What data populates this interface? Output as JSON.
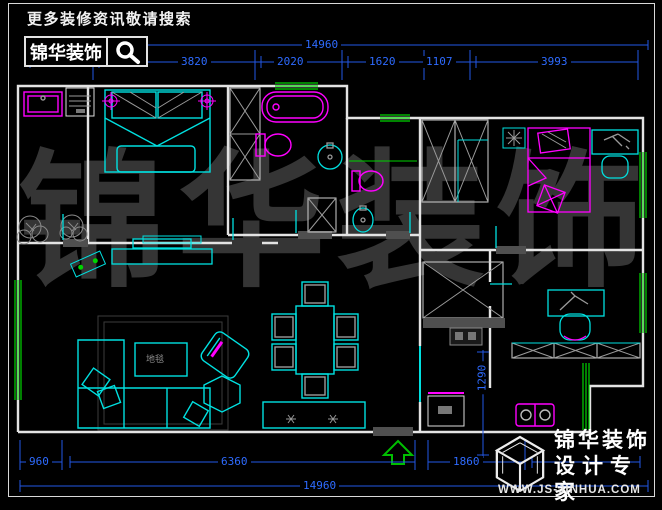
{
  "header": {
    "search_hint": "更多装修资讯敬请搜索",
    "brand": "锦华装饰",
    "search_icon": "magnifier-icon"
  },
  "watermark": {
    "char_0": "锦",
    "char_1": "华",
    "char_2": "装",
    "char_3": "饰"
  },
  "plan": {
    "coffee_table_label": "地毯",
    "entry_arrow_icon": "entry-arrow-up"
  },
  "dimensions": {
    "top_total": "14960",
    "top_segments": [
      "1560",
      "3820",
      "2020",
      "1620",
      "1107",
      "3993"
    ],
    "bottom_segments": [
      "960",
      "6360",
      "1860"
    ],
    "bottom_total": "14960",
    "kitchen_depth": "1290"
  },
  "footer": {
    "brand": "锦华装饰",
    "tagline": "设计专家",
    "url": "WWW.JS-JINHUA.COM",
    "cube_icon": "jinhua-cube-logo"
  },
  "colors": {
    "furniture_cyan": "#00e0e0",
    "fixture_magenta": "#ff00ff",
    "wall_white": "#e6e6e6",
    "window_green": "#00d400",
    "dimension_blue": "#2e6bff",
    "entry_green": "#00bf00",
    "watermark_gray": "#353535",
    "background": "#000000"
  }
}
